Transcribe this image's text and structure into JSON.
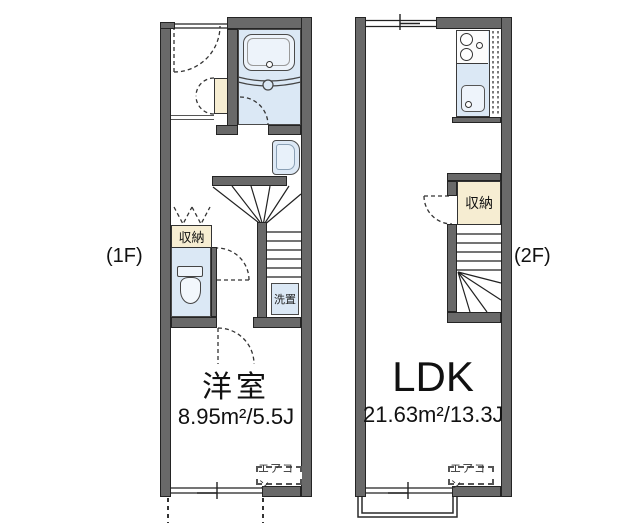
{
  "plan": {
    "floor1": {
      "floor_label": "(1F)",
      "room_name": "洋室",
      "room_area": "8.95m²/5.5J",
      "storage_label": "収納",
      "washer_label": "洗置",
      "aircon_label": "エアコン"
    },
    "floor2": {
      "floor_label": "(2F)",
      "room_name": "LDK",
      "room_area": "21.63m²/13.3J",
      "storage_label": "収納",
      "aircon_label": "エアコン"
    },
    "colors": {
      "wall": "#696969",
      "fixture_blue": "#dbe8f5",
      "storage_cream": "#f6edd2",
      "background": "#ffffff"
    }
  }
}
